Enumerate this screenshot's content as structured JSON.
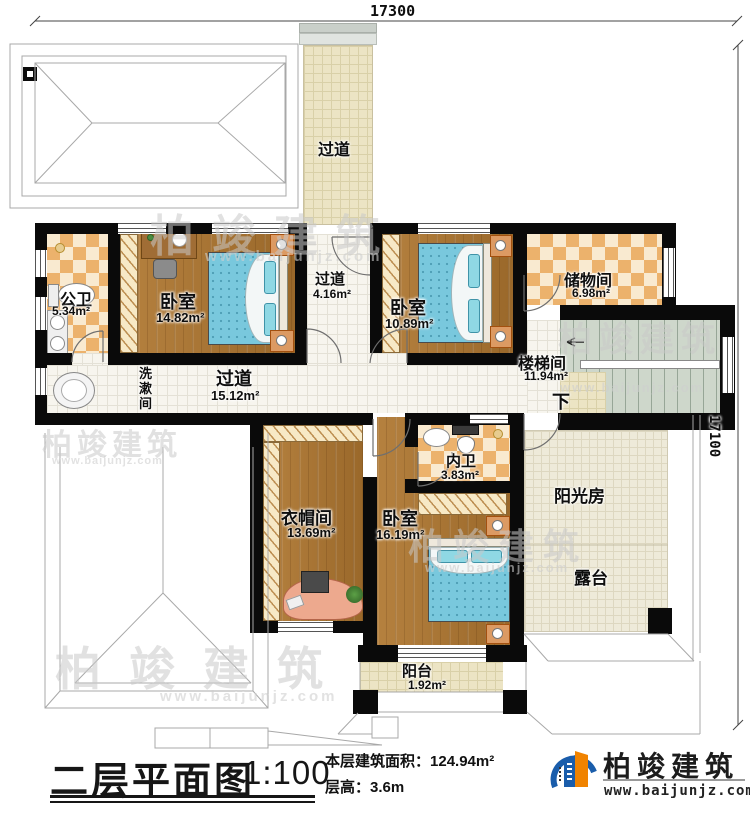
{
  "dimensions": {
    "top": "17300",
    "right": "17100"
  },
  "rooms": {
    "passage_top": {
      "name": "过道"
    },
    "public_bath": {
      "name": "公卫",
      "area": "5.34m²"
    },
    "bedroom1": {
      "name": "卧室",
      "area": "14.82m²"
    },
    "passage_mid": {
      "name": "过道",
      "area": "4.16m²"
    },
    "bedroom2": {
      "name": "卧室",
      "area": "10.89m²"
    },
    "storage": {
      "name": "储物间",
      "area": "6.98m²"
    },
    "stairwell": {
      "name": "楼梯间",
      "area": "11.94m²",
      "down": "下"
    },
    "hallway": {
      "name": "过道",
      "area": "15.12m²"
    },
    "washroom": {
      "name": "洗漱间"
    },
    "cloakroom": {
      "name": "衣帽间",
      "area": "13.69m²"
    },
    "inner_bath": {
      "name": "内卫",
      "area": "3.83m²"
    },
    "bedroom3": {
      "name": "卧室",
      "area": "16.19m²"
    },
    "balcony": {
      "name": "阳台",
      "area": "1.92m²"
    },
    "sunroom": {
      "name": "阳光房"
    },
    "terrace": {
      "name": "露台"
    }
  },
  "title_block": {
    "title": "二层平面图",
    "scale": "1:100",
    "area_label": "本层建筑面积：",
    "area_value": "124.94m²",
    "height_label": "层高：",
    "height_value": "3.6m"
  },
  "brand": {
    "name": "柏竣建筑",
    "url": "www.baijunjz.com"
  },
  "watermark": {
    "name": "柏竣建筑",
    "url": "www.baijunjz.com"
  },
  "colors": {
    "wall": "#0a0a0a",
    "wood": "#a9742f",
    "bed": "#79c8dd",
    "checker": "#ecb26c",
    "brand_blue": "#1a5dab",
    "brand_orange": "#f08300"
  }
}
